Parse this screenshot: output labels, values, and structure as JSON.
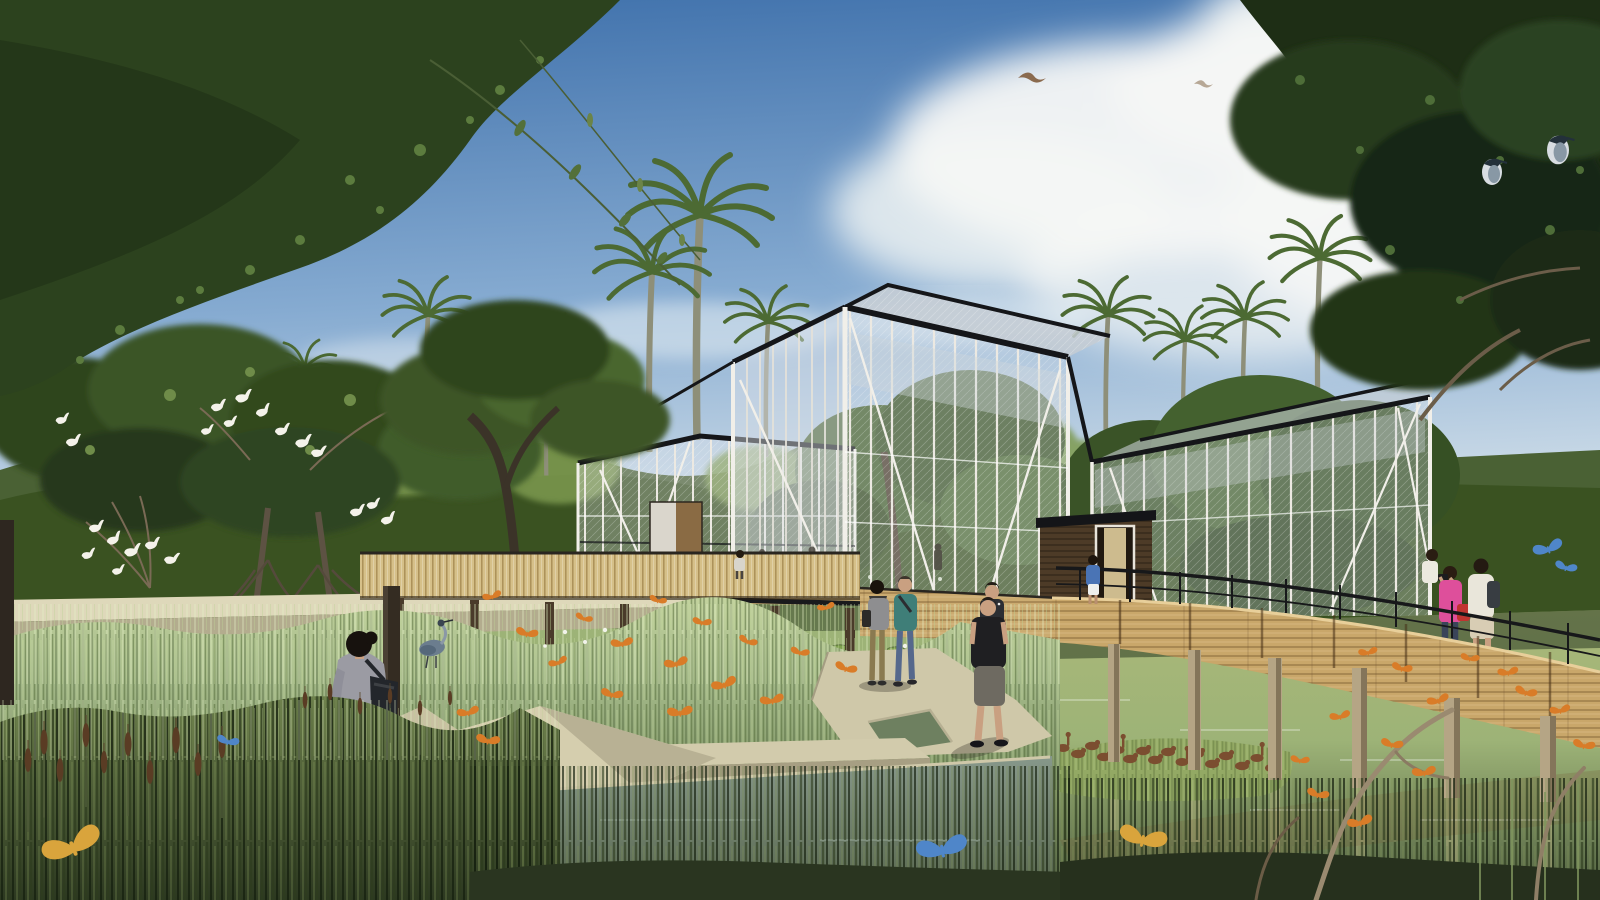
{
  "meta": {
    "title": "Wetland aviary pavilions — architectural rendering",
    "scene_type": "photorealistic architectural visualization, no UI text",
    "description": "Tropical wetland bird park: white-framed mesh aviary pavilions among palms, a curved timber boardwalk with visitors, concrete paths through reeds, egrets, herons, ducks and butterflies"
  },
  "palette": {
    "sky_top": "#3e70ab",
    "sky_mid": "#86abd1",
    "sky_horizon": "#dae5ec",
    "cloud_white": "#f5f7f5",
    "canopy_dark": "#22351a",
    "canopy_mid": "#3a5426",
    "canopy_light": "#6d8a47",
    "palm_green": "#4c6a33",
    "mesh_frame_white": "#f0eee8",
    "steel_black": "#17181a",
    "wood_boardwalk": "#c9a76a",
    "wood_dark": "#4d3b27",
    "water_green": "#9db377",
    "water_deep": "#4f5f40",
    "grass_sage": "#a6bb8b",
    "grass_shadow": "#7e9465",
    "reed_dark": "#334126",
    "path_beige": "#cfc8a9",
    "path_shadow": "#a49d82",
    "bench_wood": "#d3c193",
    "butterfly_orange": "#d97c28",
    "butterfly_blue": "#4f86c9",
    "butterfly_yellow": "#d9a43c",
    "duck_brown": "#7b4e30",
    "egret_white": "#f4f2ea",
    "skin": "#c9a081"
  },
  "structures": {
    "aviary_left": "small mesh aviary with white posts",
    "aviary_center": "main gabled mesh aviary pavilion",
    "aviary_right": "long mesh aviary enclosure",
    "entry_box": "dark timber entrance vestibule with lit doorway",
    "boardwalk": "curved timber boardwalk, plank parapet, black steel railing",
    "fence": "slatted timber boardwalk fence behind wetland",
    "walls_paths": "cast concrete walkways and angular pond edges",
    "bench": "timber bench with tilted dark backrest"
  },
  "people": [
    {
      "id": "woman-foreground",
      "desc": "woman seen from behind, grey cardigan, navy shorts, black shoulder bag"
    },
    {
      "id": "couple-woman",
      "desc": "walking woman, grey top, dark scarf, olive trousers"
    },
    {
      "id": "couple-man",
      "desc": "walking man, teal t-shirt, blue jeans"
    },
    {
      "id": "father-with-child",
      "desc": "man in black t-shirt and grey shorts carrying child on shoulders"
    },
    {
      "id": "boardwalk-photographer",
      "desc": "woman in pink jacket with red bag taking a photo"
    },
    {
      "id": "boardwalk-man",
      "desc": "man in white shirt, light shorts, dark backpack"
    },
    {
      "id": "boardwalk-third",
      "desc": "partially hidden visitor in white top"
    },
    {
      "id": "door-figure-blue",
      "desc": "visitor in blue shirt and white shorts at aviary entrance"
    },
    {
      "id": "door-figure-left",
      "desc": "small visitor at left aviary door"
    },
    {
      "id": "interior-figures",
      "desc": "small silhouettes inside the pavilion"
    }
  ],
  "wildlife": {
    "egrets": "white egrets roosting on mangrove branches (left)",
    "night_herons": "two night herons perched in the right tree",
    "grey_heron": "grey heron standing at the pond edge",
    "ducks": "flock of whistling ducks on a grassy islet",
    "butterflies": "monarch, blue morpho and yellow butterflies throughout",
    "flying_birds": "two birds flying in the sky"
  },
  "vegetation": {
    "palms": "tall moriche palms against the sky",
    "reeds": "wetland reeds, horsetails and cattails",
    "mangroves": "mangrove trees with prop roots",
    "canopy": "overhanging rainforest canopy framing top corners",
    "lily_pads": "water lilies on the pond"
  }
}
